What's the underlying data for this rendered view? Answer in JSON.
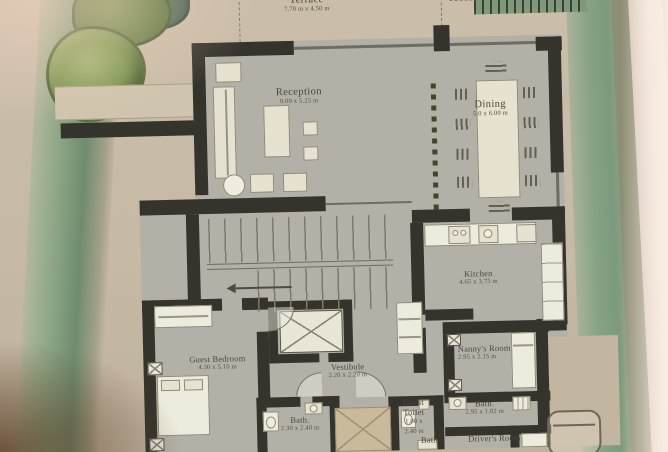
{
  "document": {
    "kind": "floor-plan-photo"
  },
  "palette": {
    "paper": "#c6baa5",
    "floor_gray": "#b2b0a7",
    "wall_ink": "#35342c",
    "landscape_green": "#7e9a7a",
    "tree_green": "#6d8c48",
    "furniture_cream": "#e7e1cf",
    "label_ink": "#4c473a"
  },
  "rooms": {
    "terrace": {
      "name": "Terrace",
      "dims": "7.70 m x 4.50 m"
    },
    "reception": {
      "name": "Reception",
      "dims": "9.00 x 5.25 m"
    },
    "dining": {
      "name": "Dining",
      "dims": "5.0 x 6.00 m"
    },
    "kitchen": {
      "name": "Kitchen",
      "dims": "4.65 x 3.75 m"
    },
    "guest_bedroom": {
      "name": "Guest Bedroom",
      "dims": "4.30 x 5.10 m"
    },
    "vestibule": {
      "name": "Vestibule",
      "dims": "2.20 x 2.20 m"
    },
    "nannys_room": {
      "name": "Nanny's Room",
      "dims": "2.95 x 2.15 m"
    },
    "guest_bath": {
      "name": "Bath.",
      "dims": "2.30 x 2.40 m"
    },
    "guest_toilet": {
      "name_line1": "Guest",
      "name_line2": "Toilet",
      "dims_line1": "1.00 x",
      "dims_line2": "2.40 m"
    },
    "nanny_bath": {
      "name": "Bath.",
      "dims": "2.95 x 1.02 m"
    },
    "small_bath": {
      "name": "Bath"
    },
    "drivers_room": {
      "name": "Driver's Room"
    }
  }
}
